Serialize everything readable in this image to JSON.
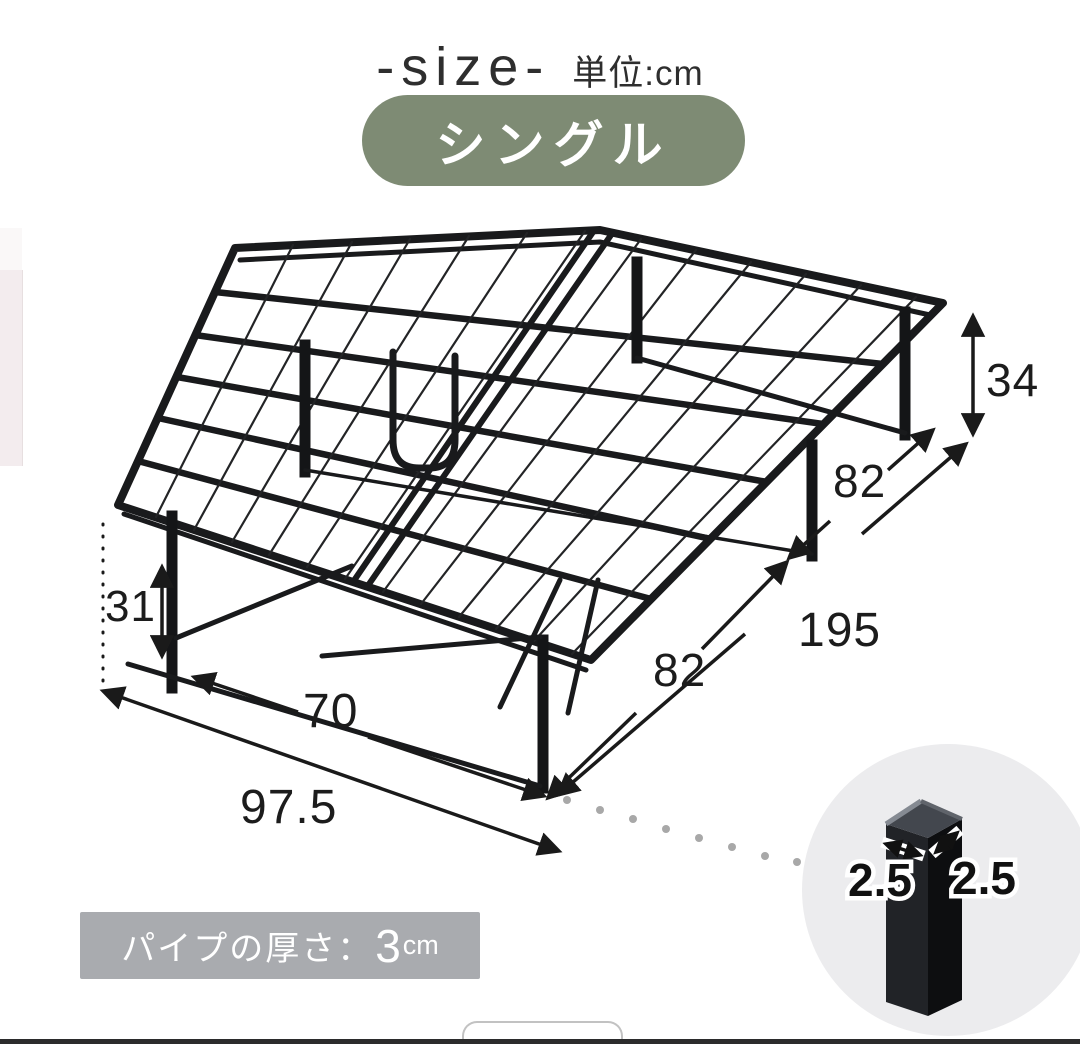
{
  "header": {
    "title": "-size-",
    "unit_label": "単位:cm"
  },
  "badge": {
    "label": "シングル"
  },
  "dimensions": {
    "total_height": "34",
    "frame_length": "195",
    "leg_span_rear": "82",
    "leg_span_front": "82",
    "inner_width": "70",
    "total_width": "97.5",
    "leg_height": "31",
    "leg_width": "2.5",
    "leg_depth": "2.5"
  },
  "pipe_note": {
    "label": "パイプの厚さ：",
    "value": "3",
    "unit": "cm"
  },
  "colors": {
    "badge_bg": "#7E8B74",
    "note_bg": "#A9ABAF",
    "frame": "#191A1C",
    "dimension_lines": "#1A1A1A",
    "inset_circle_bg": "#ECECEE"
  }
}
